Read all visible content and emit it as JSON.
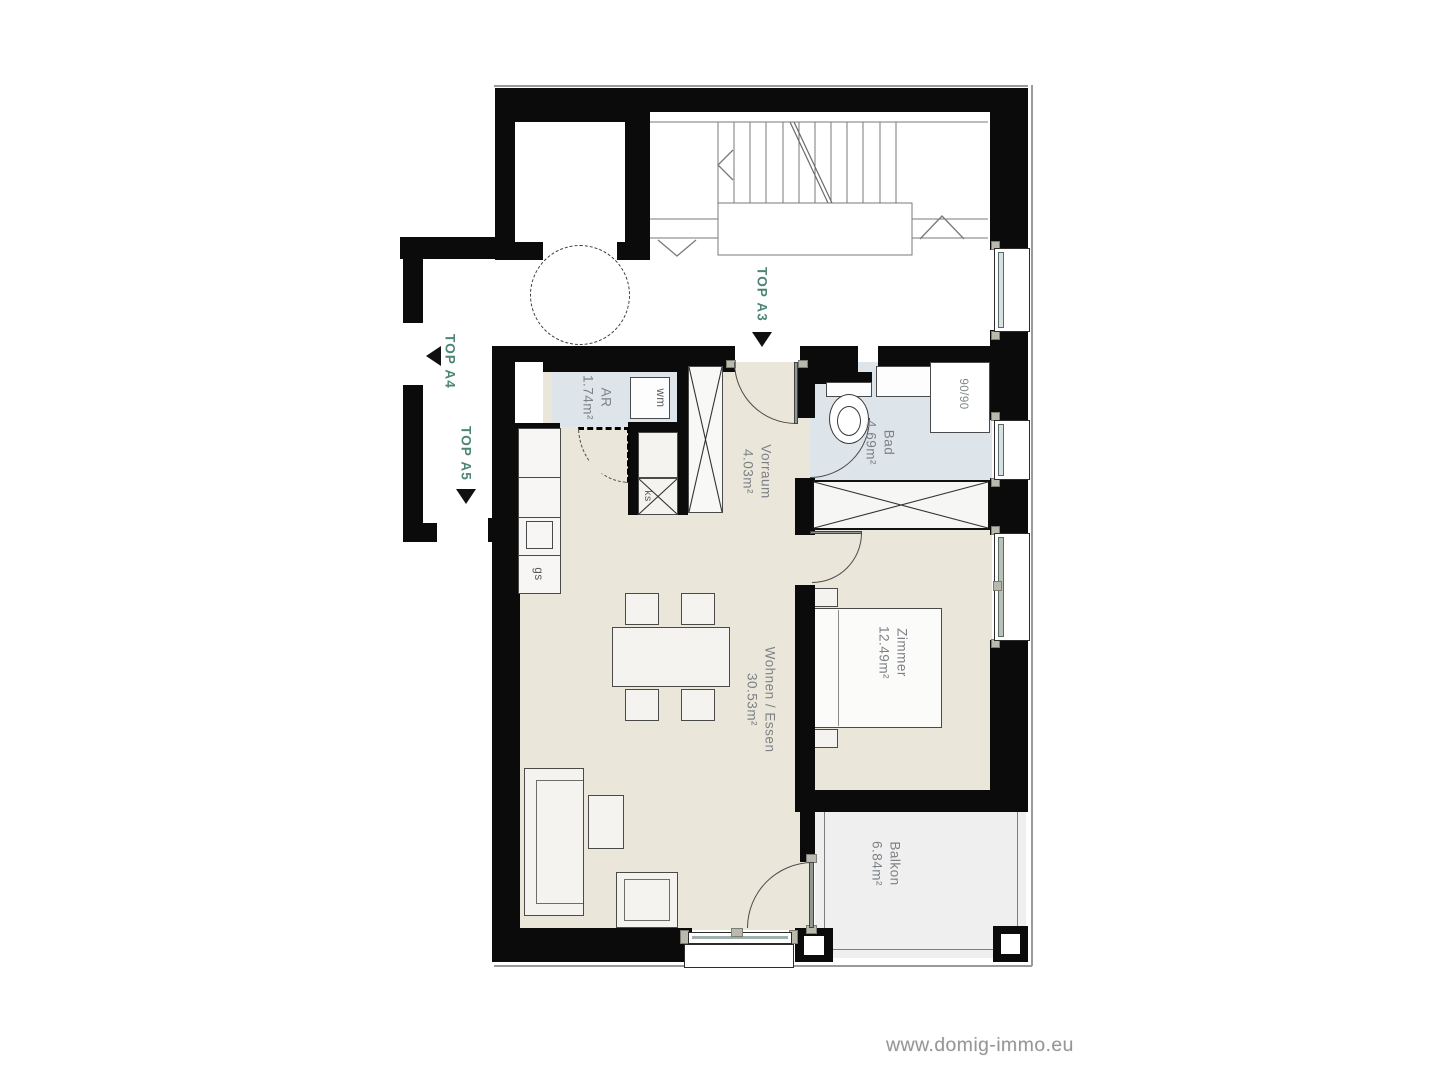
{
  "brand": {
    "website": "www.domig-immo.eu"
  },
  "units": [
    {
      "label": "TOP A3",
      "arrow": "down"
    },
    {
      "label": "TOP A4",
      "arrow": "left"
    },
    {
      "label": "TOP A5",
      "arrow": "down"
    }
  ],
  "rooms": [
    {
      "name": "Vorraum",
      "area": "4.03m²"
    },
    {
      "name": "AR",
      "area": "1.74m²"
    },
    {
      "name": "Bad",
      "area": "4.69m²"
    },
    {
      "name": "Zimmer",
      "area": "12.49m²"
    },
    {
      "name": "Wohnen / Essen",
      "area": "30.53m²"
    },
    {
      "name": "Balkon",
      "area": "6.84m²"
    }
  ],
  "fixtures": {
    "washing_machine": "wm",
    "dishwasher": "gs",
    "fridge": "ks",
    "shower_size": "90/90"
  },
  "colors": {
    "wall": "#0b0b0b",
    "floor_living": "#eae6da",
    "floor_wet": "#dde5eb",
    "floor_balcony": "#efefef",
    "unit_label": "#4e8577",
    "room_label": "#7d8186",
    "website_text": "#969696"
  }
}
